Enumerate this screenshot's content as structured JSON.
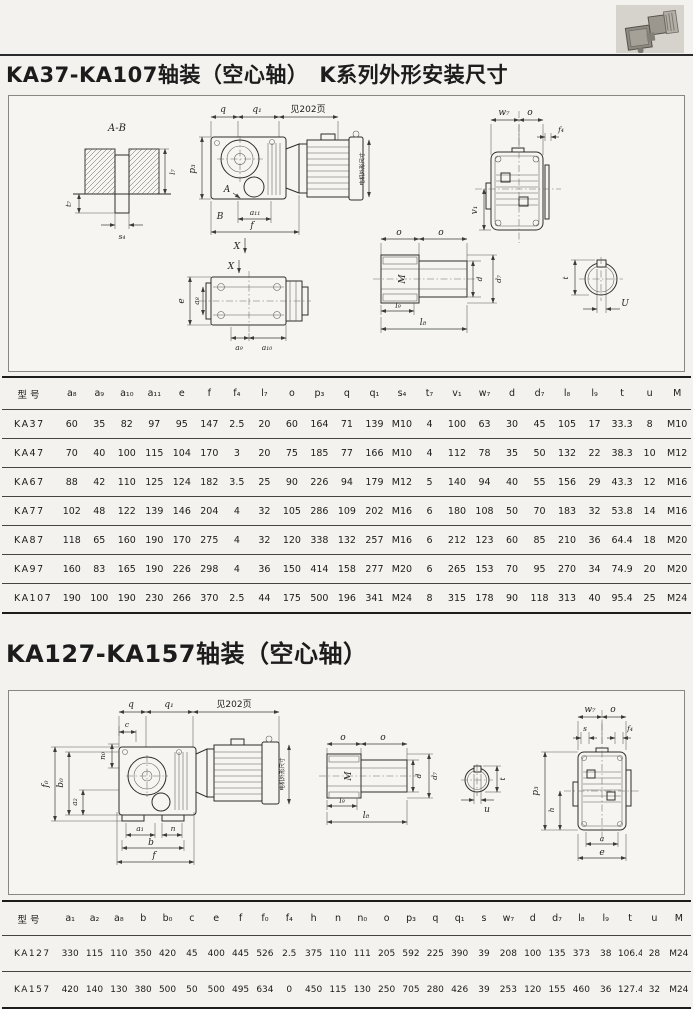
{
  "page": {
    "title1": "KA37-KA107轴装（空心轴）　K系列外形安装尺寸",
    "title2": "KA127-KA157轴装（空心轴）"
  },
  "table1": {
    "model_header": "型号",
    "headers": [
      "a₈",
      "a₉",
      "a₁₀",
      "a₁₁",
      "e",
      "f",
      "f₄",
      "l₇",
      "o",
      "p₃",
      "q",
      "q₁",
      "s₄",
      "t₇",
      "v₁",
      "w₇",
      "d",
      "d₇",
      "l₈",
      "l₉",
      "t",
      "u",
      "M"
    ],
    "rows": [
      {
        "model": "KA37",
        "values": [
          "60",
          "35",
          "82",
          "97",
          "95",
          "147",
          "2.5",
          "20",
          "60",
          "164",
          "71",
          "139",
          "M10",
          "4",
          "100",
          "63",
          "30",
          "45",
          "105",
          "17",
          "33.3",
          "8",
          "M10"
        ]
      },
      {
        "model": "KA47",
        "values": [
          "70",
          "40",
          "100",
          "115",
          "104",
          "170",
          "3",
          "20",
          "75",
          "185",
          "77",
          "166",
          "M10",
          "4",
          "112",
          "78",
          "35",
          "50",
          "132",
          "22",
          "38.3",
          "10",
          "M12"
        ]
      },
      {
        "model": "KA67",
        "values": [
          "88",
          "42",
          "110",
          "125",
          "124",
          "182",
          "3.5",
          "25",
          "90",
          "226",
          "94",
          "179",
          "M12",
          "5",
          "140",
          "94",
          "40",
          "55",
          "156",
          "29",
          "43.3",
          "12",
          "M16"
        ]
      },
      {
        "model": "KA77",
        "values": [
          "102",
          "48",
          "122",
          "139",
          "146",
          "204",
          "4",
          "32",
          "105",
          "286",
          "109",
          "202",
          "M16",
          "6",
          "180",
          "108",
          "50",
          "70",
          "183",
          "32",
          "53.8",
          "14",
          "M16"
        ]
      },
      {
        "model": "KA87",
        "values": [
          "118",
          "65",
          "160",
          "190",
          "170",
          "275",
          "4",
          "32",
          "120",
          "338",
          "132",
          "257",
          "M16",
          "6",
          "212",
          "123",
          "60",
          "85",
          "210",
          "36",
          "64.4",
          "18",
          "M20"
        ]
      },
      {
        "model": "KA97",
        "values": [
          "160",
          "83",
          "165",
          "190",
          "226",
          "298",
          "4",
          "36",
          "150",
          "414",
          "158",
          "277",
          "M20",
          "6",
          "265",
          "153",
          "70",
          "95",
          "270",
          "34",
          "74.9",
          "20",
          "M20"
        ]
      },
      {
        "model": "KA107",
        "values": [
          "190",
          "100",
          "190",
          "230",
          "266",
          "370",
          "2.5",
          "44",
          "175",
          "500",
          "196",
          "341",
          "M24",
          "8",
          "315",
          "178",
          "90",
          "118",
          "313",
          "40",
          "95.4",
          "25",
          "M24"
        ]
      }
    ]
  },
  "table2": {
    "model_header": "型号",
    "headers": [
      "a₁",
      "a₂",
      "a₈",
      "b",
      "b₀",
      "c",
      "e",
      "f",
      "f₀",
      "f₄",
      "h",
      "n",
      "n₀",
      "o",
      "p₃",
      "q",
      "q₁",
      "s",
      "w₇",
      "d",
      "d₇",
      "l₈",
      "l₉",
      "t",
      "u",
      "M"
    ],
    "rows": [
      {
        "model": "KA127",
        "values": [
          "330",
          "115",
          "110",
          "350",
          "420",
          "45",
          "400",
          "445",
          "526",
          "2.5",
          "375",
          "110",
          "111",
          "205",
          "592",
          "225",
          "390",
          "39",
          "208",
          "100",
          "135",
          "373",
          "38",
          "106.4",
          "28",
          "M24"
        ]
      },
      {
        "model": "KA157",
        "values": [
          "420",
          "140",
          "130",
          "380",
          "500",
          "50",
          "500",
          "495",
          "634",
          "0",
          "450",
          "115",
          "130",
          "250",
          "705",
          "280",
          "426",
          "39",
          "253",
          "120",
          "155",
          "460",
          "36",
          "127.4",
          "32",
          "M24"
        ]
      }
    ]
  },
  "drawing1": {
    "labels": {
      "ab": "A-B",
      "t7": "t₇",
      "l7": "l₇",
      "s4": "s₄",
      "q": "q",
      "q1": "q₁",
      "see": "见202页",
      "p3": "p₃",
      "a_marker": "A",
      "b_marker": "B",
      "a11": "a₁₁",
      "f": "f",
      "x": "X",
      "motor": "电机外形尺寸",
      "w7": "w₇",
      "o": "o",
      "f4": "f₄",
      "v1": "v₁",
      "e": "e",
      "a8": "a₈",
      "a9": "a₉",
      "a10": "a₁₀",
      "m_thread": "M",
      "d": "d",
      "d7": "d₇",
      "l9": "l₉",
      "l8": "l₈",
      "t": "t",
      "u": "U"
    }
  },
  "drawing2": {
    "labels": {
      "q": "q",
      "q1": "q₁",
      "see": "见202页",
      "c": "c",
      "n0": "n₀",
      "f0": "f₀",
      "b0": "b₀",
      "a2": "a₂",
      "a1": "a₁",
      "n": "n",
      "b": "b",
      "f": "f",
      "motor": "电机外形尺寸",
      "o": "o",
      "m_thread": "M",
      "d": "d",
      "d7": "d₇",
      "l9": "l₉",
      "l8": "l₈",
      "t": "t",
      "u": "u",
      "w7": "w₇",
      "s": "s",
      "f4": "f₄",
      "p3": "p₃",
      "h": "h",
      "a": "a",
      "e": "e"
    }
  }
}
